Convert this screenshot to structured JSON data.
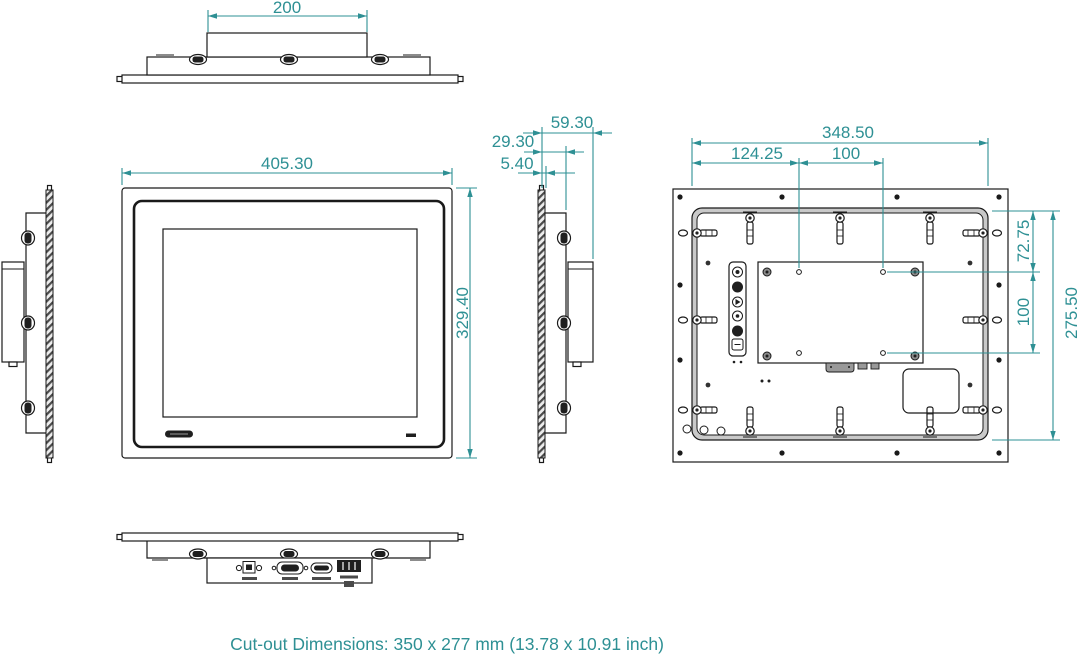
{
  "caption": "Cut-out Dimensions: 350 x 277 mm (13.78 x 10.91 inch)",
  "colors": {
    "dimension": "#2e9094",
    "linework": "#1a1a1a"
  },
  "dimensions": {
    "top_mount_width": "200",
    "front_width": "405.30",
    "front_height": "329.40",
    "total_depth": "59.30",
    "body_depth": "29.30",
    "bezel_thickness": "5.40",
    "rear_body_width": "348.50",
    "vesa_left_offset": "124.25",
    "vesa_h_pitch": "100",
    "vesa_top_offset": "72.75",
    "vesa_v_pitch": "100",
    "rear_body_height": "275.50"
  }
}
